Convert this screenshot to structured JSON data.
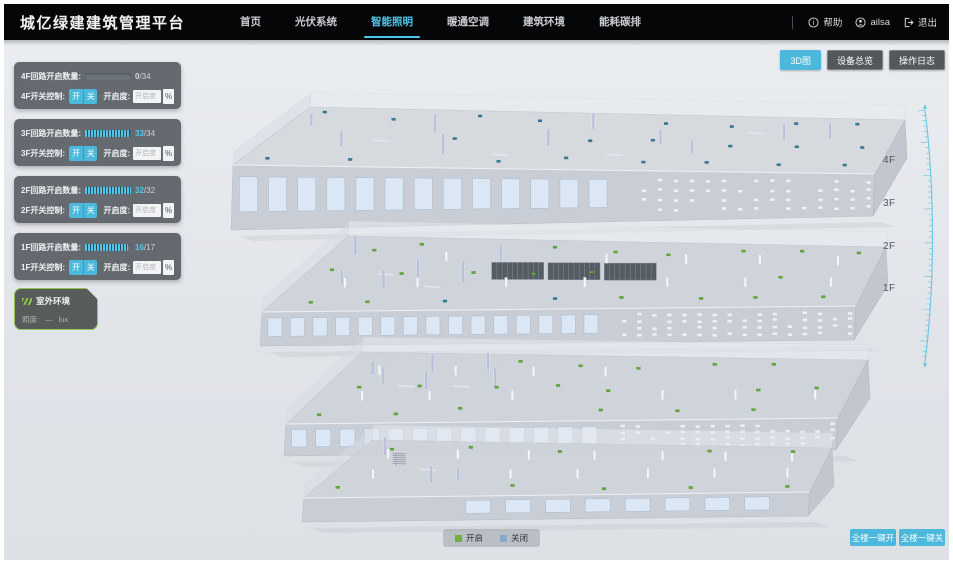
{
  "header": {
    "title": "城亿绿建建筑管理平台",
    "nav": [
      {
        "label": "首页",
        "active": false
      },
      {
        "label": "光伏系统",
        "active": false
      },
      {
        "label": "智能照明",
        "active": true
      },
      {
        "label": "暖通空调",
        "active": false
      },
      {
        "label": "建筑环境",
        "active": false
      },
      {
        "label": "能耗碳排",
        "active": false
      }
    ],
    "help_label": "帮助",
    "user_name": "ailsa",
    "logout_label": "退出"
  },
  "toolbar": {
    "buttons": [
      {
        "label": "3D图",
        "active": true
      },
      {
        "label": "设备总览",
        "active": false
      },
      {
        "label": "操作日志",
        "active": false
      }
    ]
  },
  "floor_panels": [
    {
      "floor": "4F",
      "count_label": "4F回路开启数量:",
      "count_value": "0",
      "count_total": "/34",
      "ratio": 0,
      "switch_label": "4F开关控制:",
      "on_label": "开",
      "off_label": "关",
      "openness_label": "开启度:",
      "openness_placeholder": "开启度",
      "percent_label": "%"
    },
    {
      "floor": "3F",
      "count_label": "3F回路开启数量:",
      "count_value": "33",
      "count_total": "/34",
      "ratio": 0.97,
      "switch_label": "3F开关控制:",
      "on_label": "开",
      "off_label": "关",
      "openness_label": "开启度:",
      "openness_placeholder": "开启度",
      "percent_label": "%"
    },
    {
      "floor": "2F",
      "count_label": "2F回路开启数量:",
      "count_value": "32",
      "count_total": "/32",
      "ratio": 1,
      "switch_label": "2F开关控制:",
      "on_label": "开",
      "off_label": "关",
      "openness_label": "开启度:",
      "openness_placeholder": "开启度",
      "percent_label": "%"
    },
    {
      "floor": "1F",
      "count_label": "1F回路开启数量:",
      "count_value": "16",
      "count_total": "/17",
      "ratio": 0.94,
      "switch_label": "1F开关控制:",
      "on_label": "开",
      "off_label": "关",
      "openness_label": "开启度:",
      "openness_placeholder": "开启度",
      "percent_label": "%"
    }
  ],
  "outdoor_panel": {
    "title": "室外环境",
    "metric_label": "照度:",
    "metric_value": "—",
    "metric_unit": "lux"
  },
  "floor_scale_labels": [
    "4F",
    "3F",
    "2F",
    "1F"
  ],
  "legend": {
    "items": [
      {
        "label": "开启",
        "color": "#76ad3d"
      },
      {
        "label": "关闭",
        "color": "#8aa6d0"
      }
    ]
  },
  "bulk_buttons": [
    {
      "label": "全楼一键开"
    },
    {
      "label": "全楼一键关"
    }
  ],
  "colors": {
    "accent": "#4bb8dc",
    "marker_on": "#5fae30",
    "marker_off": "#2f7d99"
  }
}
